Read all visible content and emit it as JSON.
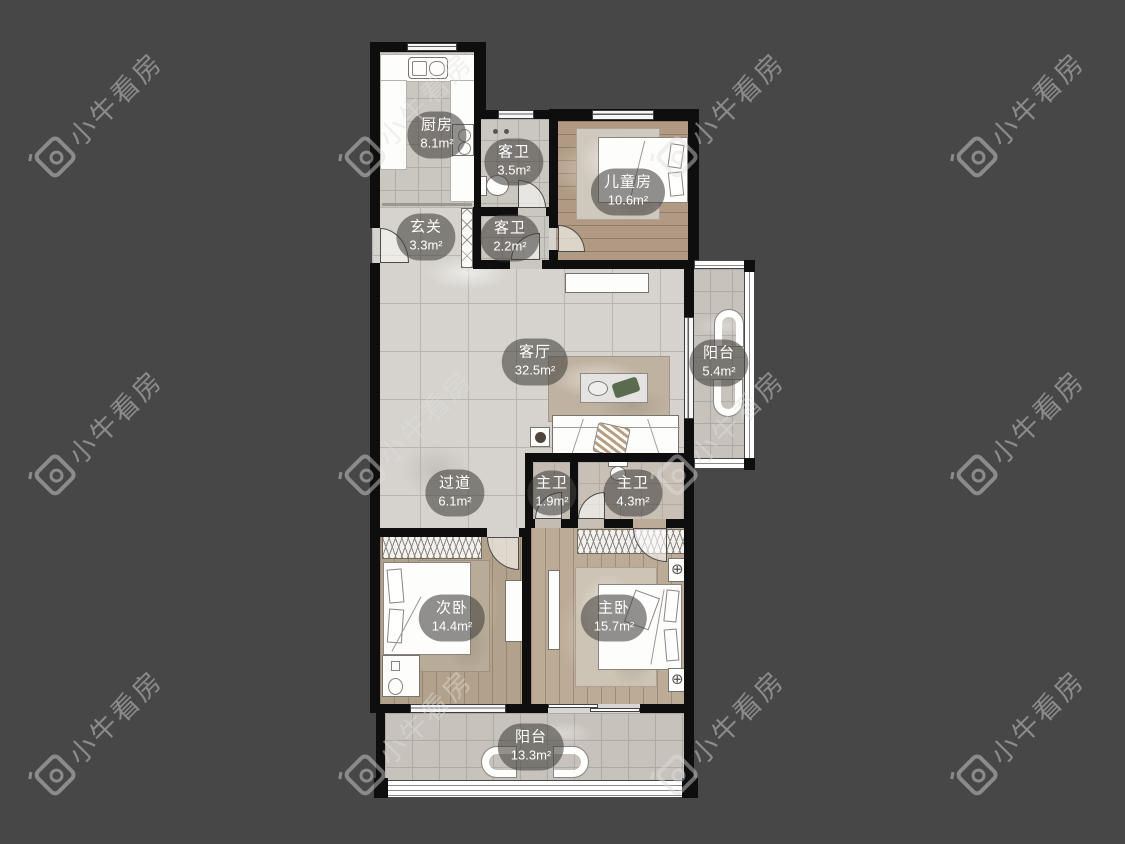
{
  "background_color": "#474747",
  "watermark": {
    "text": "小牛看房",
    "logo": "niu-camera-logo",
    "color": "#8e8e8e"
  },
  "rooms": [
    {
      "id": "kitchen",
      "name": "厨房",
      "area": "8.1m²"
    },
    {
      "id": "guest-bath-1",
      "name": "客卫",
      "area": "3.5m²"
    },
    {
      "id": "kids-room",
      "name": "儿童房",
      "area": "10.6m²"
    },
    {
      "id": "foyer",
      "name": "玄关",
      "area": "3.3m²"
    },
    {
      "id": "guest-bath-2",
      "name": "客卫",
      "area": "2.2m²"
    },
    {
      "id": "living-room",
      "name": "客厅",
      "area": "32.5m²"
    },
    {
      "id": "balcony-east",
      "name": "阳台",
      "area": "5.4m²"
    },
    {
      "id": "hallway",
      "name": "过道",
      "area": "6.1m²"
    },
    {
      "id": "master-bath-1",
      "name": "主卫",
      "area": "1.9m²"
    },
    {
      "id": "master-bath-2",
      "name": "主卫",
      "area": "4.3m²"
    },
    {
      "id": "second-bedroom",
      "name": "次卧",
      "area": "14.4m²"
    },
    {
      "id": "master-bedroom",
      "name": "主卧",
      "area": "15.7m²"
    },
    {
      "id": "balcony-south",
      "name": "阳台",
      "area": "13.3m²"
    }
  ]
}
